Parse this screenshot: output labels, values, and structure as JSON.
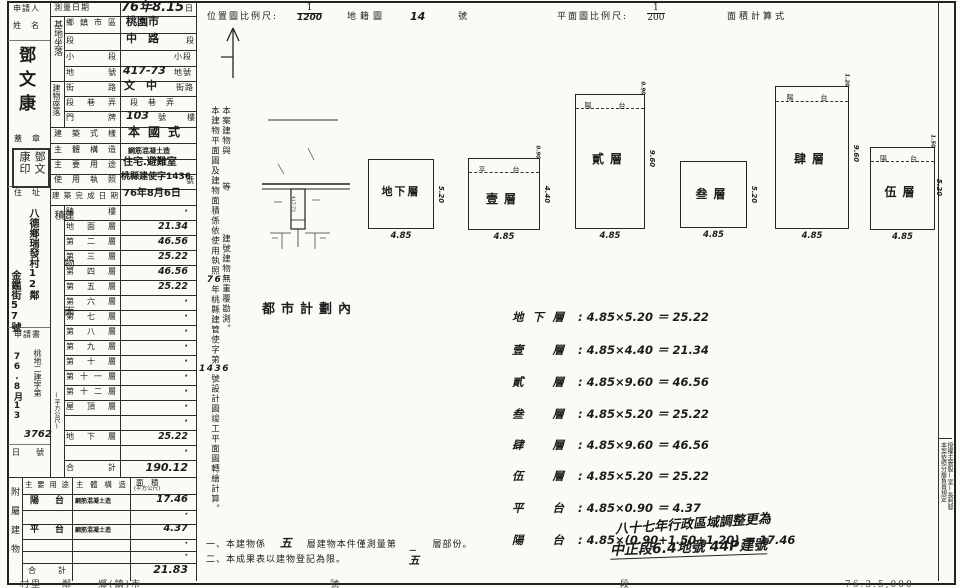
{
  "header": {
    "survey_label": "測量日期",
    "survey_value": "76年8.15",
    "survey_suffix": "日",
    "loc_scale_label": "位置圖比例尺:",
    "loc_scale_num": "1",
    "loc_scale_den": "1200",
    "cadastral_label": "地籍圖",
    "cadastral_no": "14",
    "cadastral_suffix": "號",
    "plan_scale_label": "平面圖比例尺:",
    "plan_scale_num": "1",
    "plan_scale_den": "200",
    "area_calc_label": "面積計算式"
  },
  "applicant": {
    "title_line1": "申請人",
    "title_line2": "姓　名",
    "name": "鄧文康",
    "seal_label": "蓋　章",
    "seal_text": "鄧文康印",
    "addr_label": "住　址",
    "addr_line1": "八德鄉瑞發村12鄰",
    "addr_line2": "金鑑街57號",
    "app_label": "申請書",
    "app_prefix": "桃地二建字第",
    "app_date": "76.8月13",
    "app_no": "3762",
    "app_day_suffix": "日",
    "app_no_suffix": "號"
  },
  "site": {
    "group_label": "基地坐落",
    "rows": [
      {
        "label": "鄉鎮市區",
        "value": "桃園市",
        "suffix": ""
      },
      {
        "label": "段",
        "value": "中　路",
        "suffix": "段"
      },
      {
        "label": "小段",
        "value": "",
        "suffix": "小段"
      },
      {
        "label": "地號",
        "value": "417-73",
        "suffix": "地號"
      }
    ]
  },
  "bloc": {
    "group_label": "建物座落",
    "rows": [
      {
        "label": "街路",
        "value": "文　中",
        "suffix": "街路"
      },
      {
        "label": "段巷弄",
        "value": "",
        "suffix": "段　巷　弄"
      },
      {
        "label": "門牌",
        "value": "103",
        "suffix": "號",
        "suffix2": "樓"
      }
    ]
  },
  "info": {
    "rows": [
      {
        "label": "建築式樣",
        "value": "本國式"
      },
      {
        "label": "主體構造",
        "value": "鋼筋混凝土造"
      },
      {
        "label": "主要用途",
        "value": "住宅.避難室"
      },
      {
        "label": "使用執照",
        "value": "桃縣建使字1436",
        "suffix": "號"
      },
      {
        "label": "建築完成日期",
        "value": "76年8月6日"
      }
    ]
  },
  "floor_table": {
    "group_label": "建物面積",
    "unit_label": "(平方公尺)",
    "rows": [
      {
        "label": "騎樓",
        "value": "·"
      },
      {
        "label": "地面層",
        "value": "21.34"
      },
      {
        "label": "第二層",
        "value": "46.56"
      },
      {
        "label": "第三層",
        "value": "25.22"
      },
      {
        "label": "第四層",
        "value": "46.56"
      },
      {
        "label": "第五層",
        "value": "25.22"
      },
      {
        "label": "第六層",
        "value": "·"
      },
      {
        "label": "第七層",
        "value": "·"
      },
      {
        "label": "第八層",
        "value": "·"
      },
      {
        "label": "第九層",
        "value": "·"
      },
      {
        "label": "第十層",
        "value": "·"
      },
      {
        "label": "第十一層",
        "value": "·"
      },
      {
        "label": "第十二層",
        "value": "·"
      },
      {
        "label": "屋頂層",
        "value": "·"
      },
      {
        "label": "",
        "value": "·"
      },
      {
        "label": "地下層",
        "value": "25.22"
      },
      {
        "label": "",
        "value": "·"
      },
      {
        "label": "合計",
        "value": "190.12"
      }
    ]
  },
  "annex_table": {
    "group_label": "附屬建物",
    "headers": [
      "主要用途",
      "主體構造",
      "面　積",
      "(平方公尺)"
    ],
    "rows": [
      {
        "use": "陽台",
        "structure": "鋼筋混凝土造",
        "area": "17.46"
      },
      {
        "use": "",
        "structure": "",
        "area": "·"
      },
      {
        "use": "平台",
        "structure": "鋼筋混凝土造",
        "area": "4.37"
      },
      {
        "use": "",
        "structure": "",
        "area": "·"
      },
      {
        "use": "",
        "structure": "",
        "area": "·"
      },
      {
        "use": "合計",
        "structure": "",
        "area": "21.83"
      }
    ]
  },
  "vnotes": {
    "a1": "本建物平面圖及建物面積係依使用執照",
    "a_hand1": "76",
    "a2": "年桃縣建管使字第",
    "a_hand2": "1436",
    "a3": "號設計圖竣工平面圖轉繪計算。",
    "b1": "本案建物與",
    "b2": "等",
    "b3": "建號建物無重覆勘測。"
  },
  "zoning_note": "都市計劃內",
  "map": {
    "lot_label": "417-73"
  },
  "plans": [
    {
      "name": "地下層",
      "w": "4.85",
      "h": "5.20"
    },
    {
      "name": "壹層",
      "w": "4.85",
      "h": "4.40",
      "strip": "平　台",
      "strip_dim": "0.90"
    },
    {
      "name": "貳層",
      "w": "4.85",
      "h": "9.60",
      "strip": "陽　台",
      "strip_dim": "0.90"
    },
    {
      "name": "叁層",
      "w": "4.85",
      "h": "5.20"
    },
    {
      "name": "肆層",
      "w": "4.85",
      "h": "9.60",
      "strip": "陽　台",
      "strip_dim": "1.20"
    },
    {
      "name": "伍層",
      "w": "4.85",
      "h": "5.20",
      "strip": "陽　台",
      "strip_dim": "1.50"
    }
  ],
  "calcs": {
    "rows": [
      {
        "label": "地下層",
        "formula": ": 4.85×5.20 ＝ 25.22"
      },
      {
        "label": "壹層",
        "formula": ": 4.85×4.40 ＝ 21.34"
      },
      {
        "label": "貳層",
        "formula": ": 4.85×9.60 ＝ 46.56"
      },
      {
        "label": "叁層",
        "formula": ": 4.85×5.20 ＝ 25.22"
      },
      {
        "label": "肆層",
        "formula": ": 4.85×9.60 ＝ 46.56"
      },
      {
        "label": "伍層",
        "formula": ": 4.85×5.20 ＝ 25.22"
      },
      {
        "label": "平台",
        "formula": ": 4.85×0.90 ＝ 4.37"
      },
      {
        "label": "陽台",
        "formula": ": 4.85×(0.90+1.50+1.20) ＝ 17.46"
      }
    ]
  },
  "notes": {
    "n1_pre": "一、本建物係",
    "n1_hand1": "五",
    "n1_mid": "層建物本件僅測量第",
    "n1_hand2_top": "一",
    "n1_hand2": "五",
    "n1_post": "層部份。",
    "n2": "二、本成果表以建物登記為限。"
  },
  "overlay": {
    "line1": "八十七年行政區域調整更為",
    "line2": "中正段6.4地號 44P建號"
  },
  "right_strip": {
    "col_right": "授權主管股(室)長判發",
    "col_left": "本案依照分層負責規定"
  },
  "bottom_strip": [
    "村里",
    "鄰",
    "鄉(鎮)市",
    "號",
    "段",
    "76.3.5,000"
  ]
}
